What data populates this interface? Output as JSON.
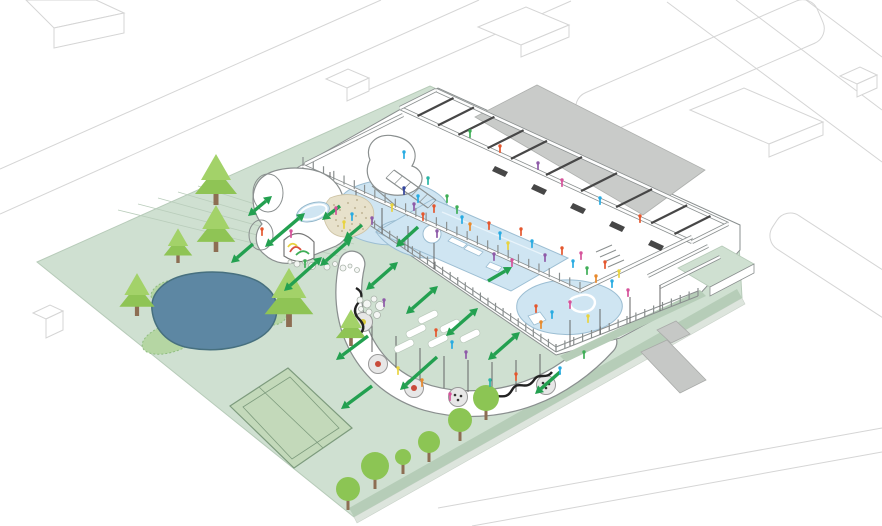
{
  "meta": {
    "kind": "architectural-axonometric-site-plan",
    "content_text": ""
  },
  "palette": {
    "background": "#ffffff",
    "context_stroke": "#d5d5d5",
    "lawn": "#cfe0d1",
    "lawn_stroke": "#b7cbb9",
    "trail": "#b9cdbb",
    "hedge": "#b6cdb8",
    "edge_path": "#dde5dd",
    "pond": "#5d87a3",
    "pond_stroke": "#47707f",
    "shore": "#b5d6a3",
    "shore_stroke": "#8fbd80",
    "tennis": "#c3d9ba",
    "tennis_stroke": "#7d9b7d",
    "conifer_dark": "#8fc455",
    "conifer_light": "#a3d269",
    "round_tree": "#8cc554",
    "trunk": "#8d6e53",
    "building_stroke": "#8a8f8f",
    "wall_dark": "#474747",
    "plinth": "#ffffff",
    "ramp": "#c9cbc9",
    "road": "#c6c8c6",
    "pool": "#cfe5f2",
    "pool_stroke": "#9cbed3",
    "sand": "#e7e1cb",
    "sand_dot": "#b4a885",
    "arrow": "#23a050",
    "table_fill": "#e7e7e7",
    "squiggle": "#222222",
    "people_colors": [
      "#e4572e",
      "#29abe2",
      "#8e5aa8",
      "#d6539b",
      "#e8d33f",
      "#3fae57",
      "#32449c",
      "#e88a2d",
      "#2ab5a5"
    ]
  },
  "scene": {
    "streets": [
      [
        0,
        169,
        381,
        0
      ],
      [
        0,
        214,
        479,
        0
      ],
      [
        352,
        97,
        571,
        1
      ],
      [
        399,
        133,
        520,
        106
      ],
      [
        520,
        106,
        591,
        131
      ],
      [
        667,
        2,
        882,
        162
      ],
      [
        736,
        0,
        882,
        110
      ],
      [
        806,
        0,
        882,
        57
      ],
      [
        438,
        508,
        882,
        428
      ],
      [
        472,
        526,
        882,
        452
      ]
    ],
    "street_islands": [
      [
        700,
        68,
        262,
        46,
        -23.5
      ],
      [
        846,
        270,
        170,
        40,
        33
      ]
    ],
    "context_buildings": [
      [
        26,
        0,
        96,
        0,
        124,
        13,
        54,
        28
      ],
      [
        54,
        28,
        124,
        13,
        124,
        33,
        54,
        48
      ],
      [
        326,
        79,
        348,
        69,
        369,
        78,
        347,
        88
      ],
      [
        347,
        88,
        369,
        78,
        369,
        91,
        347,
        101
      ],
      [
        478,
        27,
        526,
        7,
        569,
        25,
        521,
        45
      ],
      [
        521,
        45,
        569,
        25,
        569,
        37,
        521,
        57
      ],
      [
        690,
        110,
        744,
        88,
        823,
        122,
        769,
        144
      ],
      [
        769,
        144,
        823,
        122,
        823,
        135,
        769,
        157
      ],
      [
        840,
        76,
        860,
        67,
        877,
        75,
        857,
        84
      ],
      [
        857,
        84,
        877,
        75,
        877,
        88,
        857,
        97
      ],
      [
        33,
        313,
        50,
        305,
        63,
        311,
        46,
        319
      ],
      [
        46,
        319,
        63,
        311,
        63,
        330,
        46,
        338
      ]
    ],
    "lawn": [
      [
        37,
        262,
        430,
        86,
        738,
        226,
        742,
        298,
        354,
        517
      ]
    ],
    "trails": [
      [
        118,
        210,
        330,
        262
      ],
      [
        138,
        204,
        338,
        256
      ],
      [
        158,
        198,
        346,
        250
      ],
      [
        178,
        192,
        354,
        244
      ],
      [
        198,
        186,
        362,
        238
      ]
    ],
    "edge_path_band": [
      [
        742,
        298,
        354,
        517,
        357,
        523,
        745,
        304
      ]
    ],
    "hedge_band": [
      [
        742,
        298,
        354,
        517,
        349,
        508,
        737,
        289
      ]
    ],
    "hedge_se": [
      [
        560,
        356,
        700,
        290,
        706,
        296,
        566,
        362
      ]
    ],
    "tennis_outer": [
      [
        230,
        406,
        288,
        368,
        352,
        428,
        294,
        468
      ]
    ],
    "tennis_inner": [
      [
        243,
        407,
        290,
        377,
        339,
        428,
        292,
        459
      ]
    ],
    "tennis_net": [
      [
        259,
        387,
        323,
        448
      ]
    ],
    "shore_patches": [
      [
        171,
        338,
        30,
        14,
        -18
      ],
      [
        267,
        312,
        20,
        13,
        10
      ],
      [
        166,
        291,
        16,
        9,
        -25
      ]
    ],
    "pond_path": [
      "M152,310 C150,292,166,278,190,274 C218,269,252,274,266,287 C280,298,280,318,268,331 C252,347,218,353,190,348 C166,344,154,328,152,310 Z"
    ],
    "ribbon_path": [
      "M352,264 C346,290,348,318,360,342 C374,370,398,389,428,398 C460,407,498,405,530,393 C558,383,584,364,604,342"
    ],
    "plinth_path": [
      "M286,174 L438,88 L740,225 L740,250 L698,296 L620,338 L556,355 L299,179 Z"
    ],
    "ramp": [
      [
        475,
        117,
        537,
        85,
        705,
        170,
        643,
        215
      ]
    ],
    "green_platform": [
      [
        678,
        268,
        722,
        246,
        754,
        264,
        710,
        287
      ]
    ],
    "green_platform_face": [
      [
        710,
        287,
        754,
        264,
        754,
        273,
        710,
        296
      ]
    ],
    "road_cross": [
      [
        641,
        352,
        667,
        340,
        706,
        380,
        680,
        393
      ]
    ],
    "road_stub": [
      [
        657,
        330,
        676,
        321,
        690,
        334,
        671,
        343
      ]
    ],
    "pools_paths": [
      "M342,196 C352,184,380,177,404,181 C432,186,452,199,448,215 C443,231,420,241,398,244 C380,247,352,240,344,228 C338,218,336,206,342,196 Z",
      "M376,232 C382,222,398,218,414,220 C434,222,448,230,450,242 C452,252,440,260,424,258 C404,256,386,246,376,232 Z",
      "M518,300 C528,284,558,276,588,282 C614,287,628,300,620,314 C610,330,578,338,550,333 C528,329,512,316,518,300 Z"
    ],
    "main_pool": [
      [
        433,
        199,
        568,
        258,
        511,
        291,
        376,
        232
      ]
    ],
    "pool_lane": [
      [
        442,
        212,
        546,
        256
      ]
    ],
    "pool_white_bits": [
      "M452,237 l15,7 -4,4 -15,-7 Z",
      "M468,245 l15,7 -4,4 -15,-7 Z",
      "M490,262 l12,5 -4,5 -12,-5 Z",
      "M528,316 l12,-4 6,8 -12,5 Z"
    ],
    "pool_island": [
      [
        432,
        234,
        9
      ]
    ],
    "swirl": [
      "M578,296 c10,-4 20,2 16,10 c-3,7 -16,8 -22,2 c-5,-6 -2,-10 6,-12"
    ],
    "slide_tower": [
      "M370,160 C364,146,376,132,394,136 C412,139,420,153,412,166 C424,170,426,184,414,191 C400,199,380,195,372,184 C366,176,366,168,370,160 Z"
    ],
    "slide_ramps": [
      [
        394,
        170,
        436,
        200
      ],
      [
        386,
        178,
        428,
        208
      ],
      [
        372,
        186,
        408,
        216
      ]
    ],
    "wing_walls": [
      [
        436,
        90,
        728,
        224
      ],
      [
        400,
        108,
        692,
        242
      ],
      [
        436,
        90,
        400,
        108
      ],
      [
        728,
        224,
        692,
        242
      ]
    ],
    "hall_walls": [
      [
        305,
        164,
        403,
        115
      ],
      [
        303,
        166,
        580,
        291
      ],
      [
        580,
        291,
        692,
        237
      ]
    ],
    "partitions": [
      [
        648,
        276,
        708,
        246
      ],
      [
        660,
        287,
        720,
        257
      ]
    ],
    "cross_walls_t": [
      0.06,
      0.13,
      0.2,
      0.3,
      0.38,
      0.5,
      0.62,
      0.74,
      0.86,
      0.94
    ],
    "wing_outer": [
      436,
      90,
      728,
      224
    ],
    "wing_inner": [
      400,
      108,
      692,
      242
    ],
    "lockers": [
      [
        495,
        166
      ],
      [
        534,
        184
      ],
      [
        573,
        203
      ],
      [
        612,
        221
      ],
      [
        651,
        240
      ]
    ],
    "stairs": [
      [
        596,
        252,
        612,
        245
      ],
      [
        600,
        257,
        616,
        250
      ],
      [
        604,
        262,
        620,
        255
      ],
      [
        608,
        267,
        624,
        260
      ]
    ],
    "colonnade": [
      [
        299,
        177,
        556,
        352
      ],
      [
        299,
        172,
        556,
        347
      ],
      [
        556,
        352,
        698,
        296
      ],
      [
        556,
        347,
        698,
        291
      ]
    ],
    "colonnade_ticks": [
      {
        "seg": [
          299,
          177,
          556,
          352
        ],
        "step": 9,
        "len": 8
      },
      {
        "seg": [
          556,
          352,
          698,
          296
        ],
        "step": 9,
        "len": 8
      },
      {
        "seg": [
          303,
          166,
          580,
          291
        ],
        "step": 11,
        "len": 9
      }
    ],
    "poles": [
      [
        330,
        198,
        330,
        172
      ],
      [
        356,
        216,
        356,
        190
      ],
      [
        382,
        234,
        382,
        208
      ],
      [
        408,
        252,
        408,
        226
      ],
      [
        434,
        269,
        434,
        243
      ],
      [
        372,
        352,
        372,
        322
      ],
      [
        396,
        368,
        396,
        336
      ],
      [
        420,
        380,
        420,
        348
      ],
      [
        444,
        388,
        444,
        356
      ],
      [
        468,
        392,
        468,
        360
      ],
      [
        492,
        394,
        492,
        362
      ],
      [
        516,
        392,
        516,
        360
      ],
      [
        540,
        386,
        540,
        354
      ],
      [
        570,
        346,
        570,
        320
      ],
      [
        600,
        335,
        600,
        309
      ],
      [
        630,
        323,
        630,
        297
      ],
      [
        660,
        311,
        660,
        285
      ]
    ],
    "pavilion_blob": [
      "M258,182 C250,194,252,212,262,224 C254,232,254,246,264,254 C274,264,290,266,302,260 L336,246 C348,240,352,228,348,216 L342,194 C337,180,324,171,308,169 C288,166,266,170,258,182 Z"
    ],
    "pavilion_cylinders": [
      [
        268,
        193,
        15,
        19,
        0
      ],
      [
        261,
        235,
        12,
        15,
        0
      ]
    ],
    "arch": [
      "M284,240 Q299,226 314,242 L314,258 Q299,266 284,256 Z"
    ],
    "arch_squiggles": [
      {
        "d": "M290,252 q5,-9 11,-2",
        "c": "#d94f3d"
      },
      {
        "d": "M296,255 q7,-7 13,-1",
        "c": "#3fae57"
      },
      {
        "d": "M288,247 q4,-6 9,-1",
        "c": "#e8d33f"
      }
    ],
    "sand": [
      "M330,198 C344,192,362,194,370,203 C377,212,374,226,362,233 C350,240,334,238,328,228 C322,219,322,206,330,198 Z"
    ],
    "sand_dots": [
      [
        334,
        205
      ],
      [
        340,
        210
      ],
      [
        348,
        203
      ],
      [
        355,
        208
      ],
      [
        362,
        213
      ],
      [
        345,
        218
      ],
      [
        352,
        224
      ],
      [
        338,
        226
      ],
      [
        360,
        224
      ],
      [
        366,
        218
      ],
      [
        333,
        214
      ],
      [
        357,
        200
      ],
      [
        365,
        207
      ],
      [
        342,
        231
      ],
      [
        350,
        230
      ],
      [
        363,
        229
      ],
      [
        336,
        220
      ],
      [
        356,
        216
      ]
    ],
    "kiddie_pool": [
      [
        313,
        212,
        17,
        9,
        -18
      ]
    ],
    "bubbles": [
      [
        290,
        262,
        2
      ],
      [
        297,
        264,
        3
      ],
      [
        305,
        262,
        2.5
      ],
      [
        312,
        266,
        3.5
      ],
      [
        320,
        263,
        2
      ],
      [
        327,
        267,
        3
      ],
      [
        335,
        264,
        2.5
      ],
      [
        343,
        268,
        3
      ],
      [
        350,
        266,
        2
      ],
      [
        357,
        270,
        2.5
      ],
      [
        360,
        300,
        3
      ],
      [
        367,
        304,
        4
      ],
      [
        374,
        299,
        3
      ],
      [
        380,
        306,
        4.5
      ],
      [
        369,
        312,
        3
      ],
      [
        361,
        309,
        2.5
      ],
      [
        377,
        315,
        3.5
      ]
    ],
    "squiggles": [
      "M356,288 q9,5 3,14 q-8,9 0,17 q8,8 1,15",
      "M488,404 c8,-16 16,0 24,-14 c6,-11 14,2 22,-10 c5,-8 12,0 18,-8"
    ],
    "tables": [
      [
        363,
        322,
        "#d8c93c"
      ],
      [
        378,
        364,
        "#c94b3b"
      ],
      [
        414,
        388,
        "#c94b3b"
      ],
      [
        458,
        397,
        ""
      ],
      [
        546,
        385,
        ""
      ]
    ],
    "mats": [
      [
        428,
        317
      ],
      [
        450,
        326
      ],
      [
        416,
        331
      ],
      [
        438,
        341
      ],
      [
        404,
        346
      ],
      [
        470,
        336
      ]
    ],
    "conifers": [
      [
        216,
        205,
        50
      ],
      [
        216,
        252,
        46
      ],
      [
        178,
        263,
        34
      ],
      [
        137,
        316,
        42
      ],
      [
        289,
        327,
        58
      ],
      [
        351,
        346,
        36
      ]
    ],
    "round_trees": [
      [
        348,
        489,
        12
      ],
      [
        375,
        466,
        14
      ],
      [
        403,
        457,
        8
      ],
      [
        429,
        442,
        11
      ],
      [
        460,
        420,
        12
      ],
      [
        486,
        398,
        13
      ]
    ],
    "arrows": [
      [
        305,
        213,
        265,
        247,
        1
      ],
      [
        322,
        257,
        284,
        291,
        1
      ],
      [
        272,
        196,
        248,
        216,
        1
      ],
      [
        253,
        244,
        231,
        263,
        0
      ],
      [
        368,
        336,
        336,
        360,
        0
      ],
      [
        340,
        206,
        322,
        220,
        0
      ],
      [
        362,
        225,
        344,
        240,
        0
      ],
      [
        352,
        238,
        320,
        266,
        1
      ],
      [
        398,
        262,
        366,
        290,
        1
      ],
      [
        438,
        286,
        406,
        314,
        1
      ],
      [
        478,
        308,
        446,
        336,
        1
      ],
      [
        520,
        332,
        488,
        360,
        1
      ],
      [
        488,
        281,
        512,
        267,
        0
      ],
      [
        418,
        227,
        396,
        247,
        0
      ],
      [
        437,
        357,
        400,
        390,
        0
      ],
      [
        372,
        386,
        341,
        409,
        0
      ],
      [
        560,
        372,
        535,
        394,
        0
      ]
    ],
    "people": [
      [
        404,
        188,
        6
      ],
      [
        414,
        204,
        2
      ],
      [
        423,
        214,
        0
      ],
      [
        434,
        206,
        0
      ],
      [
        437,
        231,
        2
      ],
      [
        447,
        196,
        5
      ],
      [
        457,
        207,
        5
      ],
      [
        462,
        217,
        1
      ],
      [
        470,
        224,
        7
      ],
      [
        489,
        223,
        0
      ],
      [
        500,
        233,
        1
      ],
      [
        508,
        243,
        4
      ],
      [
        512,
        260,
        3
      ],
      [
        494,
        254,
        2
      ],
      [
        521,
        229,
        0
      ],
      [
        532,
        241,
        1
      ],
      [
        545,
        255,
        2
      ],
      [
        562,
        248,
        0
      ],
      [
        573,
        261,
        1
      ],
      [
        581,
        253,
        3
      ],
      [
        587,
        268,
        5
      ],
      [
        596,
        276,
        7
      ],
      [
        605,
        262,
        0
      ],
      [
        612,
        281,
        1
      ],
      [
        619,
        271,
        4
      ],
      [
        628,
        290,
        3
      ],
      [
        392,
        205,
        4
      ],
      [
        404,
        152,
        1
      ],
      [
        418,
        196,
        1
      ],
      [
        372,
        218,
        2
      ],
      [
        428,
        178,
        8
      ],
      [
        262,
        229,
        0
      ],
      [
        305,
        261,
        5
      ],
      [
        291,
        231,
        3
      ],
      [
        536,
        306,
        0
      ],
      [
        552,
        312,
        1
      ],
      [
        570,
        302,
        3
      ],
      [
        588,
        316,
        4
      ],
      [
        541,
        322,
        7
      ],
      [
        384,
        300,
        2
      ],
      [
        398,
        368,
        4
      ],
      [
        422,
        380,
        7
      ],
      [
        450,
        394,
        3
      ],
      [
        490,
        380,
        8
      ],
      [
        516,
        374,
        0
      ],
      [
        560,
        368,
        1
      ],
      [
        584,
        352,
        5
      ],
      [
        500,
        146,
        0
      ],
      [
        538,
        163,
        2
      ],
      [
        470,
        131,
        5
      ],
      [
        562,
        180,
        3
      ],
      [
        600,
        198,
        1
      ],
      [
        640,
        216,
        0
      ],
      [
        436,
        330,
        0
      ],
      [
        452,
        342,
        1
      ],
      [
        466,
        352,
        2
      ],
      [
        336,
        208,
        3
      ],
      [
        352,
        214,
        1
      ],
      [
        344,
        222,
        4
      ]
    ]
  }
}
